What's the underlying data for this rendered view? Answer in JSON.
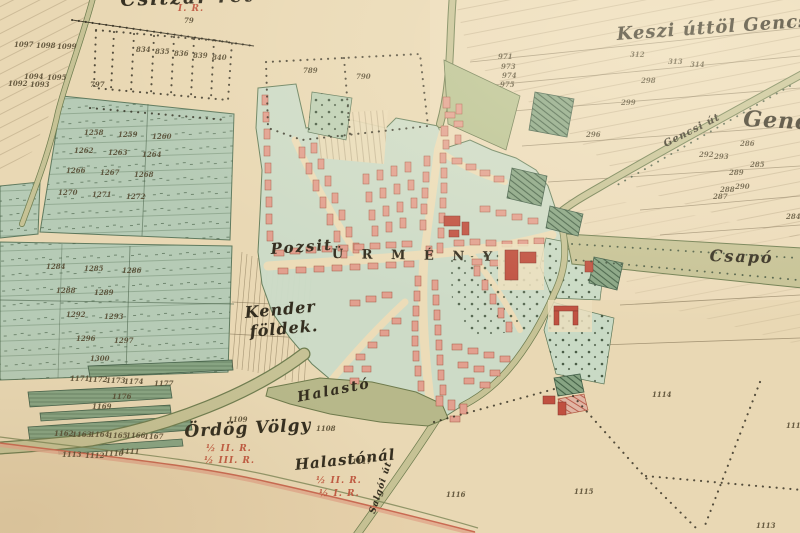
{
  "map": {
    "village_name": "ÜRMÉNY",
    "palette": {
      "paper": "#e9d8b4",
      "meadow_green": "#b6cbb6",
      "village_green": "#ccdcc8",
      "road_olive": "#c6c295",
      "road_edge": "#6f7d50",
      "building_salmon": "#e2a08f",
      "building_red": "#c05040",
      "hatch_green": "#87a483",
      "ink": "#332d1f",
      "red_ink": "#c05a42",
      "boundary_red": "#cf7a5e"
    },
    "place_labels": [
      {
        "id": "label-csitzar-ret",
        "text": "Csitzár rét",
        "x": 120,
        "y": -11,
        "size": 19,
        "rot": -2,
        "ls": 2,
        "cls": "script"
      },
      {
        "id": "label-keszi-uttol-gencs",
        "text": "Keszi úttöl Gencs",
        "x": 616,
        "y": 24,
        "size": 18,
        "rot": -4,
        "ls": 1,
        "cls": "script"
      },
      {
        "id": "label-gencs",
        "text": "Gencs",
        "x": 744,
        "y": 106,
        "size": 22,
        "rot": 3,
        "ls": 1,
        "cls": "script"
      },
      {
        "id": "label-gencsi-ut",
        "text": "Gencsi út",
        "x": 662,
        "y": 140,
        "size": 10,
        "rot": -27,
        "ls": 1,
        "cls": "script"
      },
      {
        "id": "label-csapo",
        "text": "Csapó",
        "x": 710,
        "y": 246,
        "size": 16,
        "rot": 2,
        "ls": 2,
        "cls": "script"
      },
      {
        "id": "label-pozsit",
        "text": "Pozsit",
        "x": 270,
        "y": 240,
        "size": 15,
        "rot": -4,
        "ls": 2,
        "cls": "script"
      },
      {
        "id": "label-urmeny",
        "text": "Ü R M É N Y",
        "x": 332,
        "y": 247,
        "size": 13,
        "rot": 1,
        "ls": 7,
        "cls": "caps"
      },
      {
        "id": "label-kender",
        "text": "Kender",
        "x": 244,
        "y": 303,
        "size": 16,
        "rot": -5,
        "ls": 1,
        "cls": "script"
      },
      {
        "id": "label-kender-foldek",
        "text": "földek.",
        "x": 249,
        "y": 322,
        "size": 16,
        "rot": -5,
        "ls": 1,
        "cls": "script"
      },
      {
        "id": "label-halasto",
        "text": "Halastó",
        "x": 296,
        "y": 390,
        "size": 14,
        "rot": -11,
        "ls": 2,
        "cls": "script"
      },
      {
        "id": "label-ordog-volgy",
        "text": "Ördög Völgy",
        "x": 184,
        "y": 422,
        "size": 17,
        "rot": -3,
        "ls": 1,
        "cls": "script"
      },
      {
        "id": "label-halastonal",
        "text": "Halastónál",
        "x": 294,
        "y": 456,
        "size": 15,
        "rot": -6,
        "ls": 1,
        "cls": "script"
      },
      {
        "id": "label-salgoi-ut",
        "text": "Salgói út",
        "x": 368,
        "y": 512,
        "size": 9,
        "rot": -72,
        "ls": 1,
        "cls": "script"
      }
    ],
    "class_marks": [
      {
        "id": "class-mark-top",
        "text": "I. R.",
        "x": 178,
        "y": 4
      },
      {
        "id": "class-mark-ordog-1",
        "text": "½ II. R.",
        "x": 206,
        "y": 444
      },
      {
        "id": "class-mark-ordog-2",
        "text": "½ III. R.",
        "x": 204,
        "y": 456
      },
      {
        "id": "class-mark-halastonal-1",
        "text": "½ II. R.",
        "x": 316,
        "y": 476
      },
      {
        "id": "class-mark-halastonal-2",
        "text": "½ I. R.",
        "x": 319,
        "y": 489
      }
    ],
    "parcel_numbers": [
      {
        "t": "79",
        "x": 184,
        "y": 16
      },
      {
        "t": "1097",
        "x": 14,
        "y": 40
      },
      {
        "t": "1098",
        "x": 36,
        "y": 41
      },
      {
        "t": "1099",
        "x": 57,
        "y": 42
      },
      {
        "t": "1094",
        "x": 24,
        "y": 72
      },
      {
        "t": "1095",
        "x": 47,
        "y": 73
      },
      {
        "t": "1092",
        "x": 8,
        "y": 79
      },
      {
        "t": "1093",
        "x": 30,
        "y": 80
      },
      {
        "t": "797",
        "x": 90,
        "y": 80
      },
      {
        "t": "834",
        "x": 136,
        "y": 45
      },
      {
        "t": "835",
        "x": 155,
        "y": 47
      },
      {
        "t": "836",
        "x": 174,
        "y": 49
      },
      {
        "t": "839",
        "x": 193,
        "y": 51
      },
      {
        "t": "840",
        "x": 212,
        "y": 53
      },
      {
        "t": "789",
        "x": 303,
        "y": 66
      },
      {
        "t": "790",
        "x": 356,
        "y": 72
      },
      {
        "t": "971",
        "x": 498,
        "y": 52
      },
      {
        "t": "973",
        "x": 501,
        "y": 62
      },
      {
        "t": "974",
        "x": 502,
        "y": 71
      },
      {
        "t": "975",
        "x": 500,
        "y": 80
      },
      {
        "t": "312",
        "x": 630,
        "y": 50
      },
      {
        "t": "313",
        "x": 668,
        "y": 57
      },
      {
        "t": "314",
        "x": 690,
        "y": 60
      },
      {
        "t": "298",
        "x": 641,
        "y": 76
      },
      {
        "t": "299",
        "x": 621,
        "y": 98
      },
      {
        "t": "296",
        "x": 586,
        "y": 130
      },
      {
        "t": "286",
        "x": 740,
        "y": 139
      },
      {
        "t": "292",
        "x": 699,
        "y": 150
      },
      {
        "t": "293",
        "x": 714,
        "y": 152
      },
      {
        "t": "285",
        "x": 750,
        "y": 160
      },
      {
        "t": "289",
        "x": 729,
        "y": 168
      },
      {
        "t": "290",
        "x": 735,
        "y": 182
      },
      {
        "t": "288",
        "x": 720,
        "y": 185
      },
      {
        "t": "287",
        "x": 713,
        "y": 192
      },
      {
        "t": "284",
        "x": 786,
        "y": 212
      },
      {
        "t": "1258",
        "x": 84,
        "y": 128
      },
      {
        "t": "1259",
        "x": 118,
        "y": 130
      },
      {
        "t": "1260",
        "x": 152,
        "y": 132
      },
      {
        "t": "1262",
        "x": 74,
        "y": 146
      },
      {
        "t": "1263",
        "x": 108,
        "y": 148
      },
      {
        "t": "1264",
        "x": 142,
        "y": 150
      },
      {
        "t": "1266",
        "x": 66,
        "y": 166
      },
      {
        "t": "1267",
        "x": 100,
        "y": 168
      },
      {
        "t": "1268",
        "x": 134,
        "y": 170
      },
      {
        "t": "1270",
        "x": 58,
        "y": 188
      },
      {
        "t": "1271",
        "x": 92,
        "y": 190
      },
      {
        "t": "1272",
        "x": 126,
        "y": 192
      },
      {
        "t": "1284",
        "x": 46,
        "y": 262
      },
      {
        "t": "1285",
        "x": 84,
        "y": 264
      },
      {
        "t": "1286",
        "x": 122,
        "y": 266
      },
      {
        "t": "1288",
        "x": 56,
        "y": 286
      },
      {
        "t": "1289",
        "x": 94,
        "y": 288
      },
      {
        "t": "1292",
        "x": 66,
        "y": 310
      },
      {
        "t": "1293",
        "x": 104,
        "y": 312
      },
      {
        "t": "1296",
        "x": 76,
        "y": 334
      },
      {
        "t": "1297",
        "x": 114,
        "y": 336
      },
      {
        "t": "1300",
        "x": 90,
        "y": 354
      },
      {
        "t": "1171",
        "x": 70,
        "y": 374
      },
      {
        "t": "1172",
        "x": 88,
        "y": 375
      },
      {
        "t": "1173",
        "x": 106,
        "y": 376
      },
      {
        "t": "1174",
        "x": 124,
        "y": 377
      },
      {
        "t": "1177",
        "x": 154,
        "y": 379
      },
      {
        "t": "1176",
        "x": 112,
        "y": 392
      },
      {
        "t": "1169",
        "x": 92,
        "y": 402
      },
      {
        "t": "1162",
        "x": 54,
        "y": 429
      },
      {
        "t": "1163",
        "x": 72,
        "y": 430
      },
      {
        "t": "1164",
        "x": 90,
        "y": 430
      },
      {
        "t": "1165",
        "x": 108,
        "y": 431
      },
      {
        "t": "1166",
        "x": 126,
        "y": 431
      },
      {
        "t": "1167",
        "x": 144,
        "y": 432
      },
      {
        "t": "1113",
        "x": 62,
        "y": 450
      },
      {
        "t": "1112",
        "x": 85,
        "y": 451
      },
      {
        "t": "1110",
        "x": 104,
        "y": 449
      },
      {
        "t": "1111",
        "x": 120,
        "y": 447
      },
      {
        "t": "1109",
        "x": 228,
        "y": 415
      },
      {
        "t": "1108",
        "x": 316,
        "y": 424
      },
      {
        "t": "1117",
        "x": 352,
        "y": 457
      },
      {
        "t": "1116",
        "x": 446,
        "y": 490
      },
      {
        "t": "1114",
        "x": 652,
        "y": 390
      },
      {
        "t": "1115",
        "x": 574,
        "y": 487
      },
      {
        "t": "1113",
        "x": 756,
        "y": 521
      },
      {
        "t": "1111",
        "x": 786,
        "y": 421
      }
    ]
  }
}
